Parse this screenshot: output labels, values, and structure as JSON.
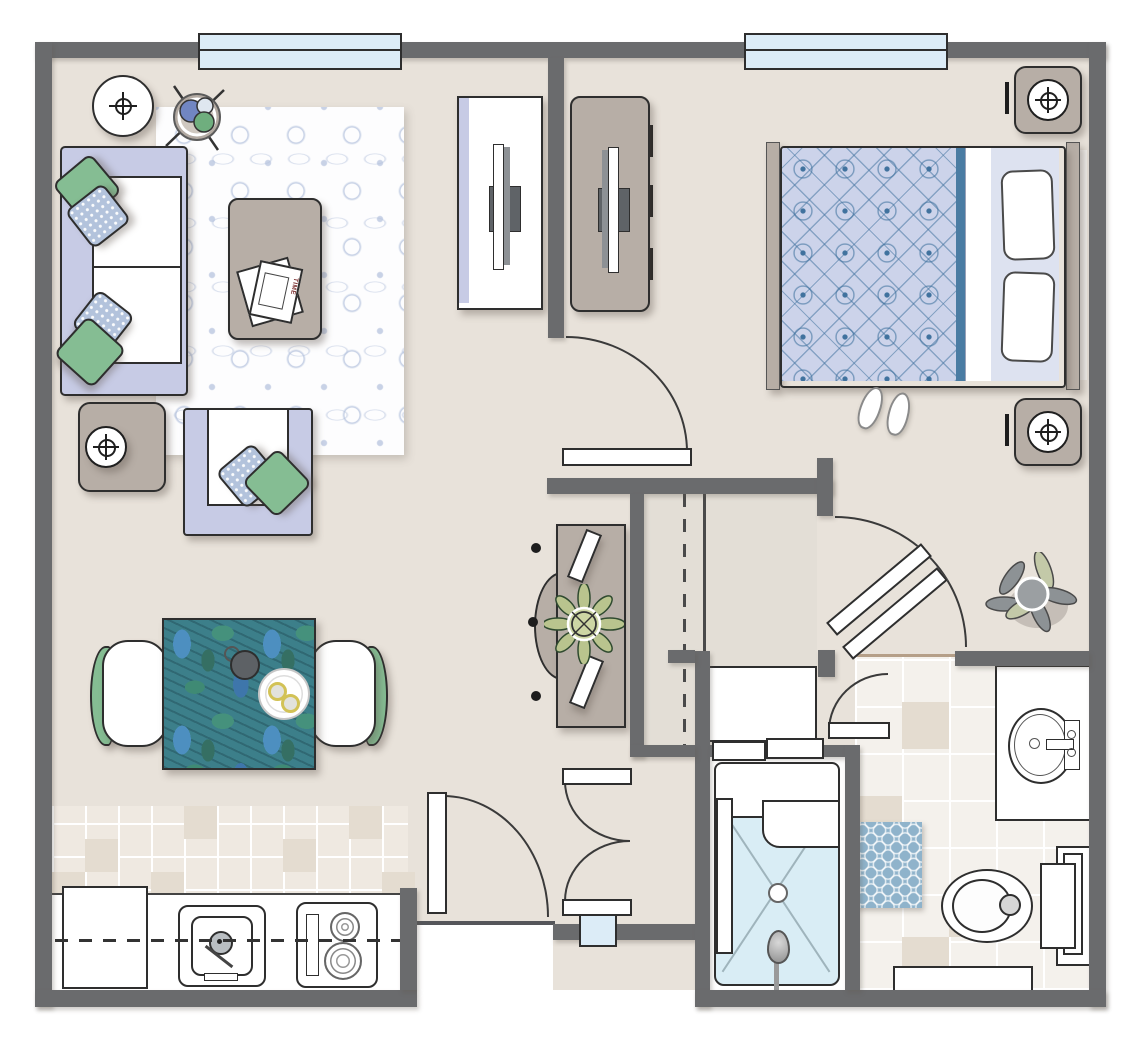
{
  "floorplan": {
    "description": "One-bedroom apartment floor plan, top-down furnished view",
    "magazine": {
      "label": "TIME"
    },
    "colors": {
      "wall": "#6a6b6d",
      "floor": "#e8e2da",
      "floor-closet": "#e3ded6",
      "lavender": "#c7cbe5",
      "lavender-light": "#dde2f0",
      "taupe": "#b7aea6",
      "green": "#85bd93",
      "window-blue": "#dcecf7",
      "shower-blue": "#d9edf5",
      "mat-blue": "#8fb3cb",
      "duvet-base": "#ccd3ea",
      "duvet-line": "#40729e",
      "duvet-edge": "#4a7ca3",
      "tablecloth-teal": "#3c7f8a",
      "rug-motif": "#c3cde1",
      "tile-accent": "#e4dcd0",
      "outline": "#2e2e2e"
    },
    "rooms": [
      {
        "name": "living-room",
        "furniture": [
          "sofa-with-pillows",
          "armchair-with-pillows",
          "coffee-table",
          "magazine",
          "area-rug",
          "round-side-table-lamp",
          "end-table-lamp",
          "tv-console-white",
          "potted-plant"
        ]
      },
      {
        "name": "bedroom",
        "furniture": [
          "double-bed",
          "pillows",
          "nightstand-lamp-top",
          "nightstand-lamp-bottom",
          "dresser-with-tv",
          "slippers"
        ]
      },
      {
        "name": "dining-area",
        "furniture": [
          "dining-table",
          "dining-chair-left",
          "dining-chair-right",
          "coffee-cup",
          "plate-with-eggs"
        ]
      },
      {
        "name": "kitchen",
        "furniture": [
          "refrigerator",
          "sink",
          "cooktop",
          "counter",
          "tile-floor"
        ]
      },
      {
        "name": "hallway",
        "furniture": [
          "console-table",
          "console-plant",
          "closet-with-rod"
        ]
      },
      {
        "name": "bathroom",
        "furniture": [
          "walk-in-shower",
          "vanity-sink",
          "toilet",
          "towel-rack",
          "bath-mat",
          "floor-mat",
          "corner-plant",
          "cabinet"
        ]
      }
    ],
    "openings": {
      "windows": [
        "top-wall-window-left",
        "top-wall-window-right"
      ],
      "doors": [
        "kitchen-door",
        "bedroom-door",
        "entry-double-door",
        "vestibule-folding-door",
        "bathroom-door"
      ]
    }
  }
}
